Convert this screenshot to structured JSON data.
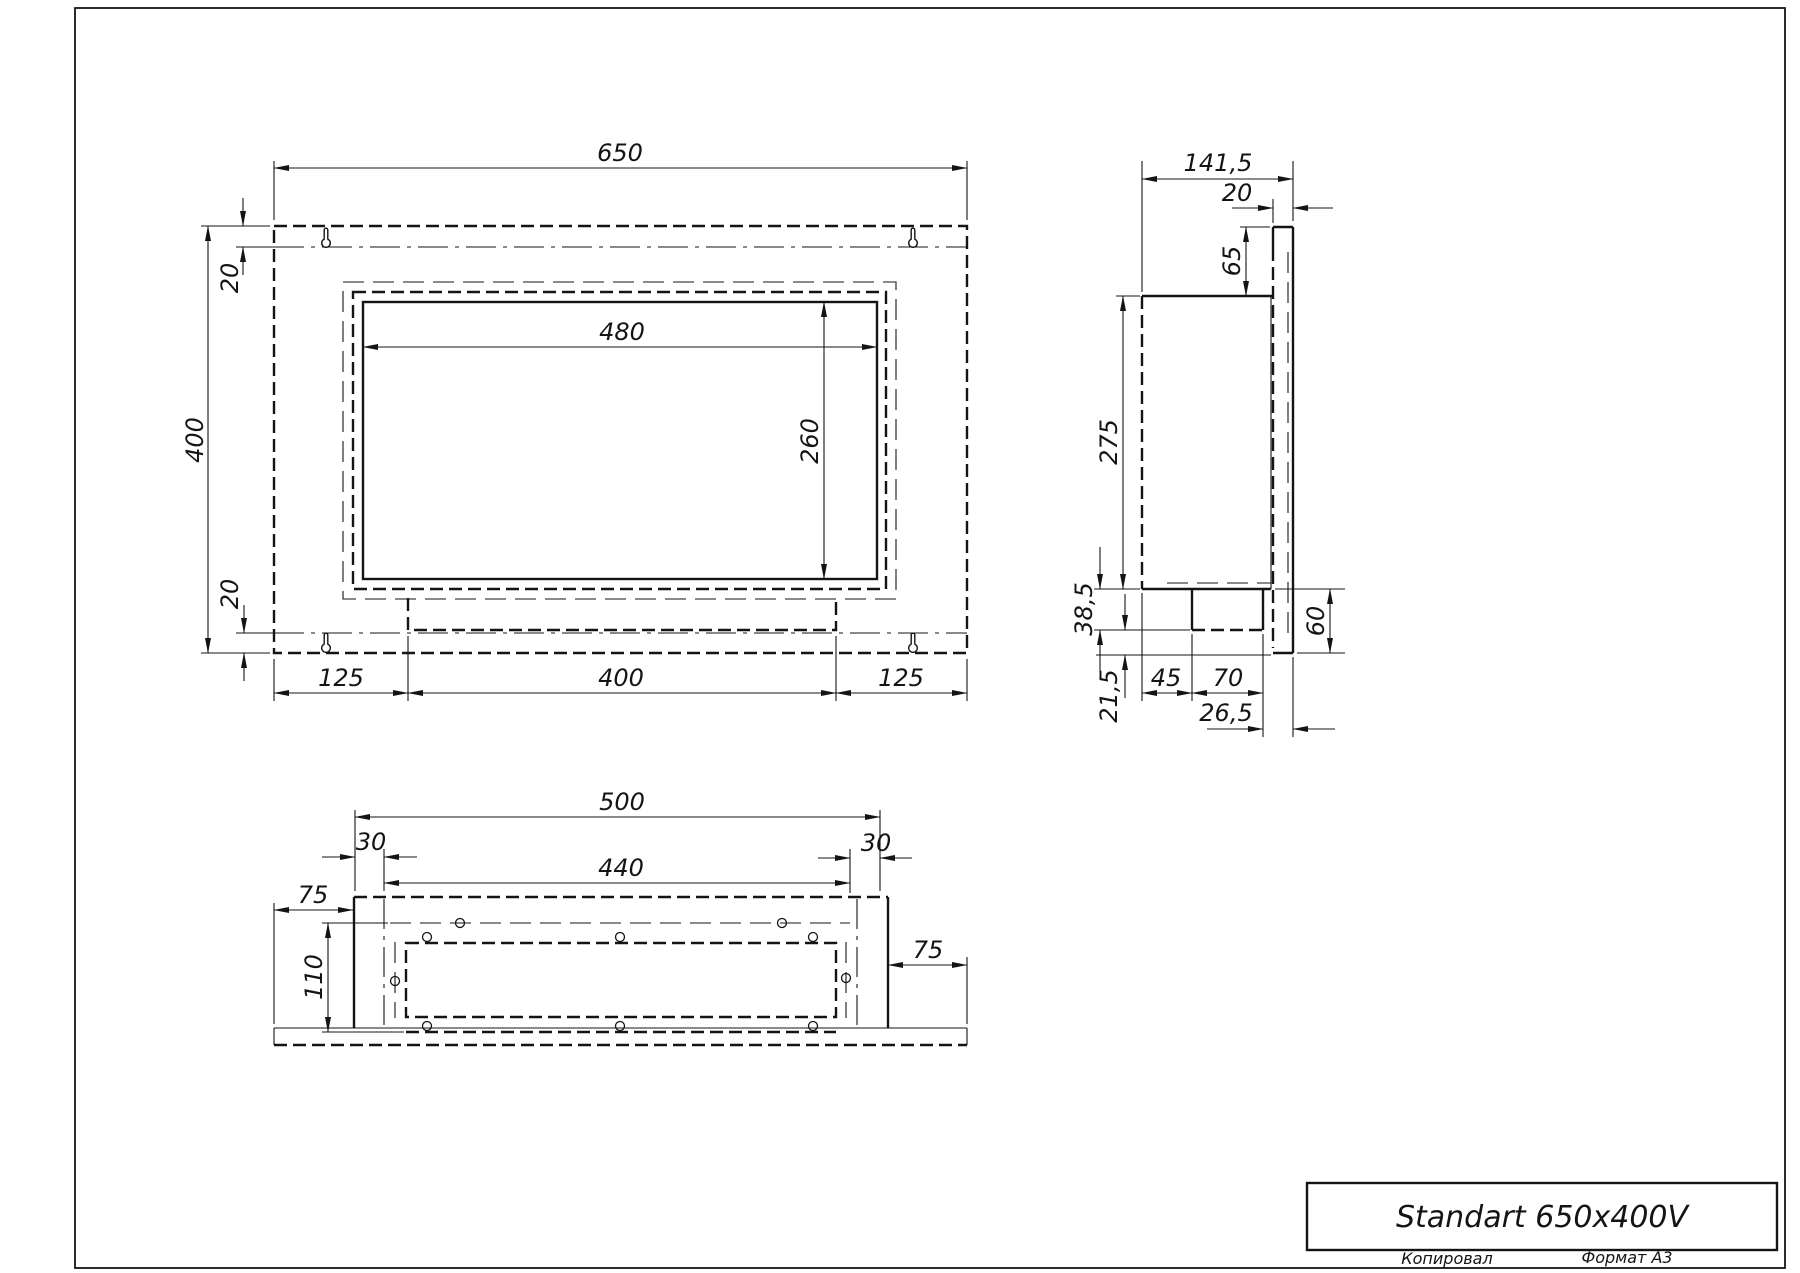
{
  "front_view": {
    "width": "650",
    "height": "400",
    "top_offset": "20",
    "bottom_offset": "20",
    "opening_width": "480",
    "opening_height": "260",
    "left_margin": "125",
    "tray_width": "400",
    "right_margin": "125"
  },
  "side_view": {
    "depth": "141,5",
    "flange_width": "20",
    "back_top_height": "65",
    "body_height": "275",
    "tray_drop": "38,5",
    "lower_drop": "21,5",
    "tray_offset": "45",
    "tray_depth": "70",
    "back_offset": "26,5",
    "bottom_height": "60"
  },
  "bottom_view": {
    "body_width": "500",
    "left_step": "30",
    "inner_width": "440",
    "right_step": "30",
    "left_flange": "75",
    "depth": "110",
    "right_flange": "75"
  },
  "title_block": {
    "title": "Standart 650x400V"
  },
  "footer": {
    "copied_by": "Копировал",
    "format": "Формат А3"
  }
}
